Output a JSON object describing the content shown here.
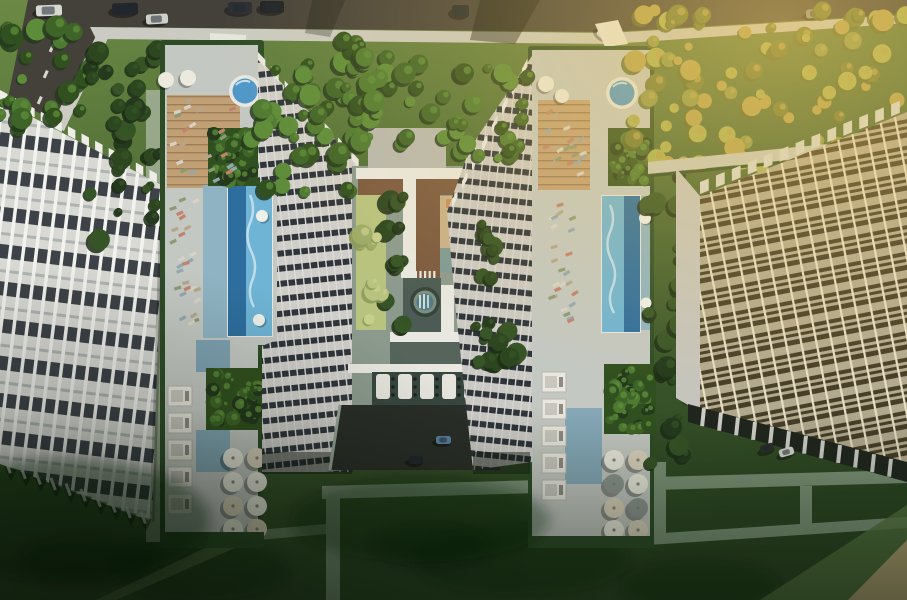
{
  "meta": {
    "type": "architectural-aerial-render",
    "description": "Top-down aerial rendering of a residential complex: two high-rise towers with landscaped amenity roof decks (round spa pools, lap pools, wooden sun decks, pergola lounges, umbrella clusters, green planter cubes), a central courtyard with fountain plaza, crosswalks and drop-off drive, flanked by two long apartment slab buildings, a road with cars along the top, lawns, hedges and walking paths below, warm sunlight falling from the upper right."
  },
  "palette": {
    "grassBase": "#4a6833",
    "grassLight": "#6c8a45",
    "grassDark": "#22371b",
    "treeDark": "#24391d",
    "tree1": "#31501f",
    "tree2": "#3f6428",
    "tree3": "#4e7a31",
    "tree4": "#5d8c3a",
    "oliveA": "#6e7a33",
    "oliveB": "#8c9747",
    "oliveC": "#aab152",
    "gold": "#d4b055",
    "paleA": "#9dab67",
    "paleB": "#b8c37f",
    "road": "#44403a",
    "sidewalk": "#cbcbc3",
    "pathGray": "#7d9378",
    "pathLight": "#c8c9bd",
    "tanCorner": "#b2a173",
    "deck": "#c4c8c2",
    "deckWhite": "#e9e8e0",
    "hedge": "#2d4c26",
    "wood": "#c2a076",
    "woodDark": "#7b5a40",
    "tanDeck": "#c9b089",
    "orangeDeck": "#c98f56",
    "poolDark": "#2e6e9e",
    "poolLight": "#6fb4d4",
    "poolRing": "#e8e8e2",
    "tealWet": "#8fb3c2",
    "tealPlaza": "#7e9a96",
    "tealDeep": "#4c5c54",
    "courtLow": "#55655b",
    "podBg": "#37463e",
    "facadeBg": "#d7d7d1",
    "facadeDark": "#31373d",
    "facadeFin": "#f2f2ee",
    "towerBg": "#e2e0da",
    "towerDark": "#343a41",
    "towerFin": "#efeeea",
    "rightBg": "#a9a79c",
    "rightDark": "#26241f",
    "rightFin": "#e9e7e0",
    "rightBase": "#20261e",
    "endWall": "#c6c5bd",
    "cabana": "#e9e7df",
    "umbrella": "#eceade",
    "umbCream": "#ddd3bd",
    "umbGray": "#8e968f",
    "fountainRing": "#36443c",
    "fountainMid": "#7e8e80",
    "fountainWater": "#4e7e8a",
    "driveAsphalt": "#2a2e28"
  },
  "scene": {
    "road_cars": [
      {
        "x": 36,
        "y": 5,
        "w": 26,
        "h": 11,
        "c": "#d9d9d3",
        "a": -2
      },
      {
        "x": 112,
        "y": 3,
        "w": 26,
        "h": 12,
        "c": "#23272b",
        "a": -2
      },
      {
        "x": 228,
        "y": 2,
        "w": 24,
        "h": 12,
        "c": "#2a2e33",
        "a": 0
      },
      {
        "x": 260,
        "y": 1,
        "w": 24,
        "h": 12,
        "c": "#1e2226",
        "a": 0
      },
      {
        "x": 146,
        "y": 14,
        "w": 22,
        "h": 10,
        "c": "#cfd0ca",
        "a": -3
      },
      {
        "x": 452,
        "y": 5,
        "w": 17,
        "h": 12,
        "c": "#23282c",
        "a": 0
      },
      {
        "x": 806,
        "y": 9,
        "w": 18,
        "h": 9,
        "c": "#8e8e86",
        "a": -4
      },
      {
        "x": 597,
        "y": 30,
        "w": 13,
        "h": 9,
        "c": "#dadad2",
        "a": 40
      }
    ],
    "drive_cars": [
      {
        "x": 436,
        "y": 436,
        "w": 15,
        "h": 8,
        "c": "#5b80a0",
        "a": 0
      },
      {
        "x": 409,
        "y": 456,
        "w": 14,
        "h": 8,
        "c": "#22262a",
        "a": 0
      },
      {
        "x": 477,
        "y": 454,
        "w": 15,
        "h": 8,
        "c": "#d6d6d0",
        "a": 0
      }
    ],
    "parked_cars": [
      {
        "x": 760,
        "y": 444,
        "w": 14,
        "h": 8,
        "c": "#2b2f2b",
        "a": -16
      },
      {
        "x": 779,
        "y": 448,
        "w": 15,
        "h": 8,
        "c": "#d4d4cc",
        "a": -16
      }
    ],
    "road_dashes": [
      [
        52,
        44
      ],
      [
        46,
        70
      ],
      [
        40,
        96
      ]
    ],
    "decks": {
      "left": {
        "umbrella_grid": {
          "cols": [
            233,
            257
          ],
          "rows": [
            458,
            482,
            506,
            529
          ],
          "r": 10
        },
        "top_umbrellas": [
          [
            166,
            80,
            8
          ],
          [
            188,
            78,
            8
          ]
        ],
        "cabanas": {
          "x": 168,
          "y0": 386,
          "step": 27,
          "n": 5,
          "w": 24,
          "h": 20
        },
        "floats": [
          [
            262,
            216,
            6
          ],
          [
            259,
            320,
            6
          ]
        ]
      },
      "right": {
        "umbrella_grid": {
          "cols": [
            614,
            638
          ],
          "rows": [
            460,
            484,
            508,
            530
          ],
          "r": 10
        },
        "top_umbrellas": [
          [
            546,
            84,
            8
          ],
          [
            562,
            96,
            7
          ]
        ],
        "cabanas": {
          "x": 542,
          "y0": 372,
          "step": 27,
          "n": 5,
          "w": 24,
          "h": 20
        },
        "floats": [
          [
            645,
            218,
            6
          ],
          [
            646,
            303,
            5.5
          ]
        ]
      }
    },
    "pods": {
      "x0": 376,
      "y": 374,
      "step": 22,
      "n": 5
    },
    "crosswalks": [
      {
        "x": 401,
        "y": 271,
        "n": 8,
        "step": 4.6
      },
      {
        "x": 463,
        "y": 315,
        "n": 6,
        "step": 4.2
      }
    ],
    "lounge_zones": [
      {
        "x": 168,
        "y": 100,
        "w": 70,
        "h": 86,
        "n": 22
      },
      {
        "x": 168,
        "y": 198,
        "w": 34,
        "h": 134,
        "n": 26
      },
      {
        "x": 540,
        "y": 104,
        "w": 48,
        "h": 84,
        "n": 20
      },
      {
        "x": 544,
        "y": 198,
        "w": 36,
        "h": 130,
        "n": 24
      }
    ],
    "lounge_colors": [
      "#d8d2c6",
      "#c2826d",
      "#b3a68c",
      "#93a7b0",
      "#8a9a74"
    ],
    "tree_clusters": [
      {
        "x": 0,
        "y": 26,
        "w": 92,
        "h": 106,
        "n": 26,
        "kind": "green"
      },
      {
        "x": 88,
        "y": 44,
        "w": 74,
        "h": 200,
        "n": 30,
        "kind": "shade"
      },
      {
        "x": 250,
        "y": 40,
        "w": 122,
        "h": 152,
        "n": 46,
        "kind": "green"
      },
      {
        "x": 356,
        "y": 56,
        "w": 100,
        "h": 92,
        "n": 26,
        "kind": "green"
      },
      {
        "x": 452,
        "y": 60,
        "w": 80,
        "h": 100,
        "n": 22,
        "kind": "green"
      },
      {
        "x": 384,
        "y": 190,
        "w": 20,
        "h": 140,
        "n": 12,
        "kind": "shade"
      },
      {
        "x": 476,
        "y": 178,
        "w": 20,
        "h": 156,
        "n": 12,
        "kind": "shade"
      },
      {
        "x": 356,
        "y": 196,
        "w": 30,
        "h": 134,
        "n": 10,
        "kind": "pale"
      },
      {
        "x": 478,
        "y": 330,
        "w": 40,
        "h": 36,
        "n": 10,
        "kind": "shade"
      },
      {
        "x": 628,
        "y": 10,
        "w": 279,
        "h": 158,
        "n": 85,
        "kind": "olive"
      },
      {
        "x": 648,
        "y": 168,
        "w": 44,
        "h": 300,
        "n": 26,
        "kind": "shade"
      }
    ]
  }
}
